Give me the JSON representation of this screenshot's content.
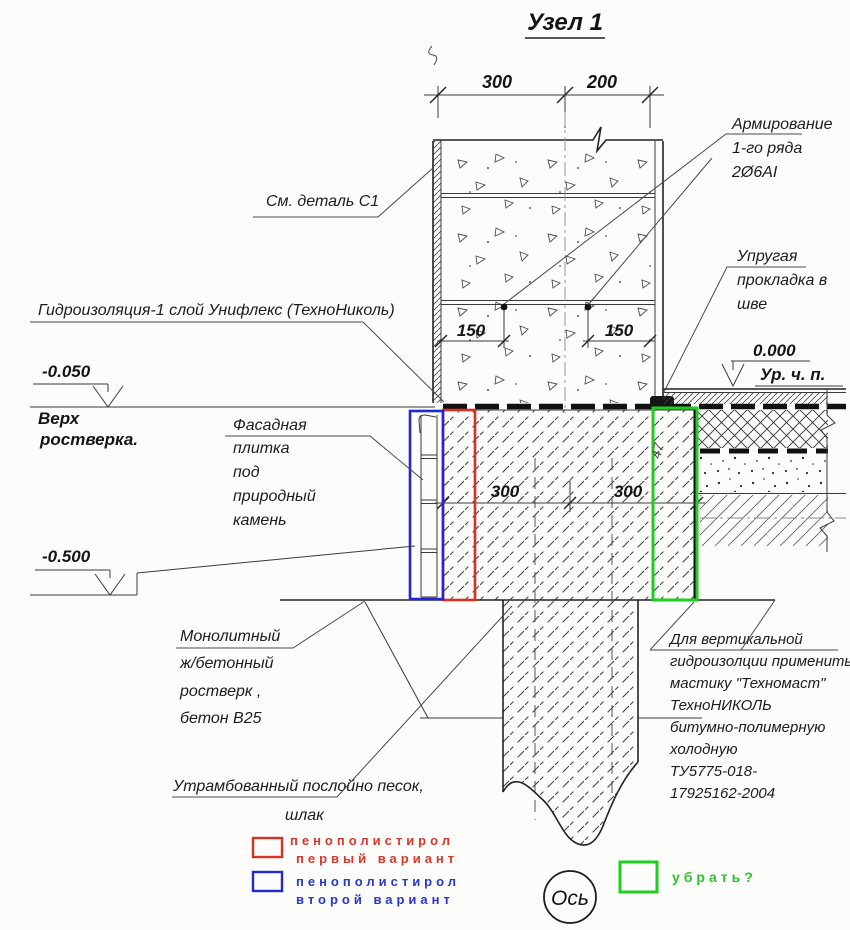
{
  "title": "Узел  1",
  "colors": {
    "red": "#d93025",
    "blue": "#2328d0",
    "green": "#22cd22",
    "ink": "#222222"
  },
  "dimensions": {
    "top": [
      "300",
      "200"
    ],
    "rebar": [
      "150",
      "150"
    ],
    "grillage": [
      "300",
      "300"
    ]
  },
  "levels": {
    "zero": "0.000",
    "zero_sub": "Ур. ч. п.",
    "top_grillage": "-0.050",
    "top_grillage_sub1": "Верх",
    "top_grillage_sub2": "ростверка.",
    "ground": "-0.500"
  },
  "labels": {
    "see_detail": "См. деталь С1",
    "reinforcement": [
      "Армирование",
      "1-го ряда",
      "2Ø6АI"
    ],
    "elastic": [
      "Упругая",
      "прокладка в",
      "шве"
    ],
    "waterproofing": "Гидроизоляция-1 слой Унифлекс (ТехноНиколь)",
    "facade": [
      "Фасадная",
      "плитка",
      "под",
      "природный",
      "камень"
    ],
    "grillage": [
      "Монолитный",
      "ж/бетонный",
      "ростверк ,",
      "бетон В25"
    ],
    "sand": [
      "Утрамбованный послойно песок,",
      "шлак"
    ],
    "mastic": [
      "Для вертикальной",
      "гидроизолции применить",
      "мастику \"Техномаст\"",
      "ТехноНИКОЛЬ",
      "битумно-полимерную",
      "холодную",
      "ТУ5775-018-",
      "17925162-2004"
    ],
    "axis": "Ось",
    "note_47": "47"
  },
  "legend": {
    "variant1": [
      "пенополистирол",
      "первый вариант"
    ],
    "variant2": [
      "пенополистирол",
      "второй вариант"
    ],
    "remove": "убрать?"
  }
}
